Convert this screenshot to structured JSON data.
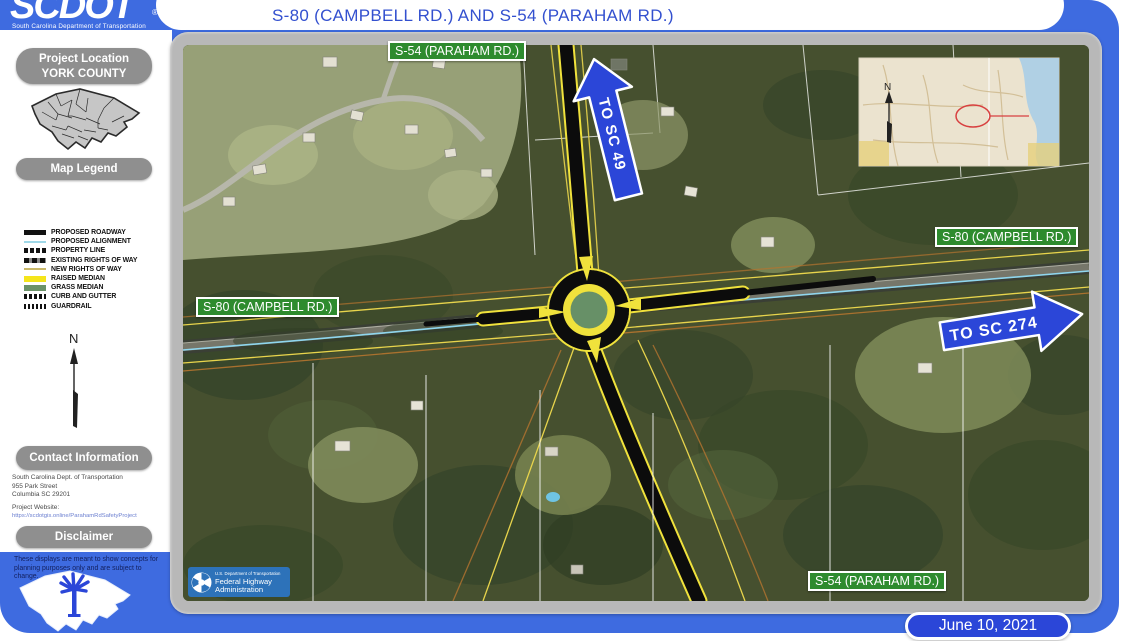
{
  "header": {
    "logo_text": "SCDOT",
    "logo_registered": "®",
    "logo_tagline": "South Carolina Department of Transportation",
    "title": "S-80 (CAMPBELL RD.) AND S-54 (PARAHAM RD.)"
  },
  "sidebar": {
    "project_location_label": "Project Location",
    "project_location_value": "YORK COUNTY",
    "map_legend_label": "Map Legend",
    "legend_labels": [
      "PROPOSED ROADWAY",
      "PROPOSED ALIGNMENT",
      "PROPERTY LINE",
      "EXISTING RIGHTS OF WAY",
      "NEW RIGHTS OF WAY",
      "RAISED MEDIAN",
      "GRASS MEDIAN",
      "CURB AND GUTTER",
      "GUARDRAIL"
    ],
    "north_label": "N",
    "contact_header": "Contact Information",
    "contact_address": [
      "South Carolina Dept. of Transportation",
      "955 Park Street",
      "Columbia SC 29201"
    ],
    "project_website_label": "Project Website:",
    "project_website_url": "https://scdotgis.online/ParahamRdSafetyProject",
    "disclaimer_header": "Disclaimer",
    "disclaimer_text": "These displays are meant to show concepts for planning purposes only and are subject to change."
  },
  "map": {
    "road_labels": {
      "top": "S-54 (PARAHAM RD.)",
      "left": "S-80 (CAMPBELL RD.)",
      "right": "S-80 (CAMPBELL RD.)",
      "bottom": "S-54 (PARAHAM RD.)"
    },
    "direction_arrows": {
      "to_sc_49": "TO SC 49",
      "to_sc_274": "TO SC 274"
    },
    "inset_north_label": "N",
    "fhwa_logo": {
      "agency_small": "U.S. Department of Transportation",
      "line1": "Federal Highway",
      "line2": "Administration"
    }
  },
  "footer": {
    "date": "June 10, 2021"
  },
  "colors": {
    "page_blue": "#3e6be0",
    "arrow_blue": "#2b46d8",
    "road_label_green": "#2e8b2e",
    "frame_gray": "#b8b8b8",
    "pill_gray": "#8f8f8f",
    "raised_median_yellow": "#f0e23c",
    "grass_median_green": "#679067",
    "proposed_alignment_blue": "#8fd6ee",
    "new_row_yellow": "#e8d44c",
    "fhwa_blue": "#2d72b9"
  }
}
